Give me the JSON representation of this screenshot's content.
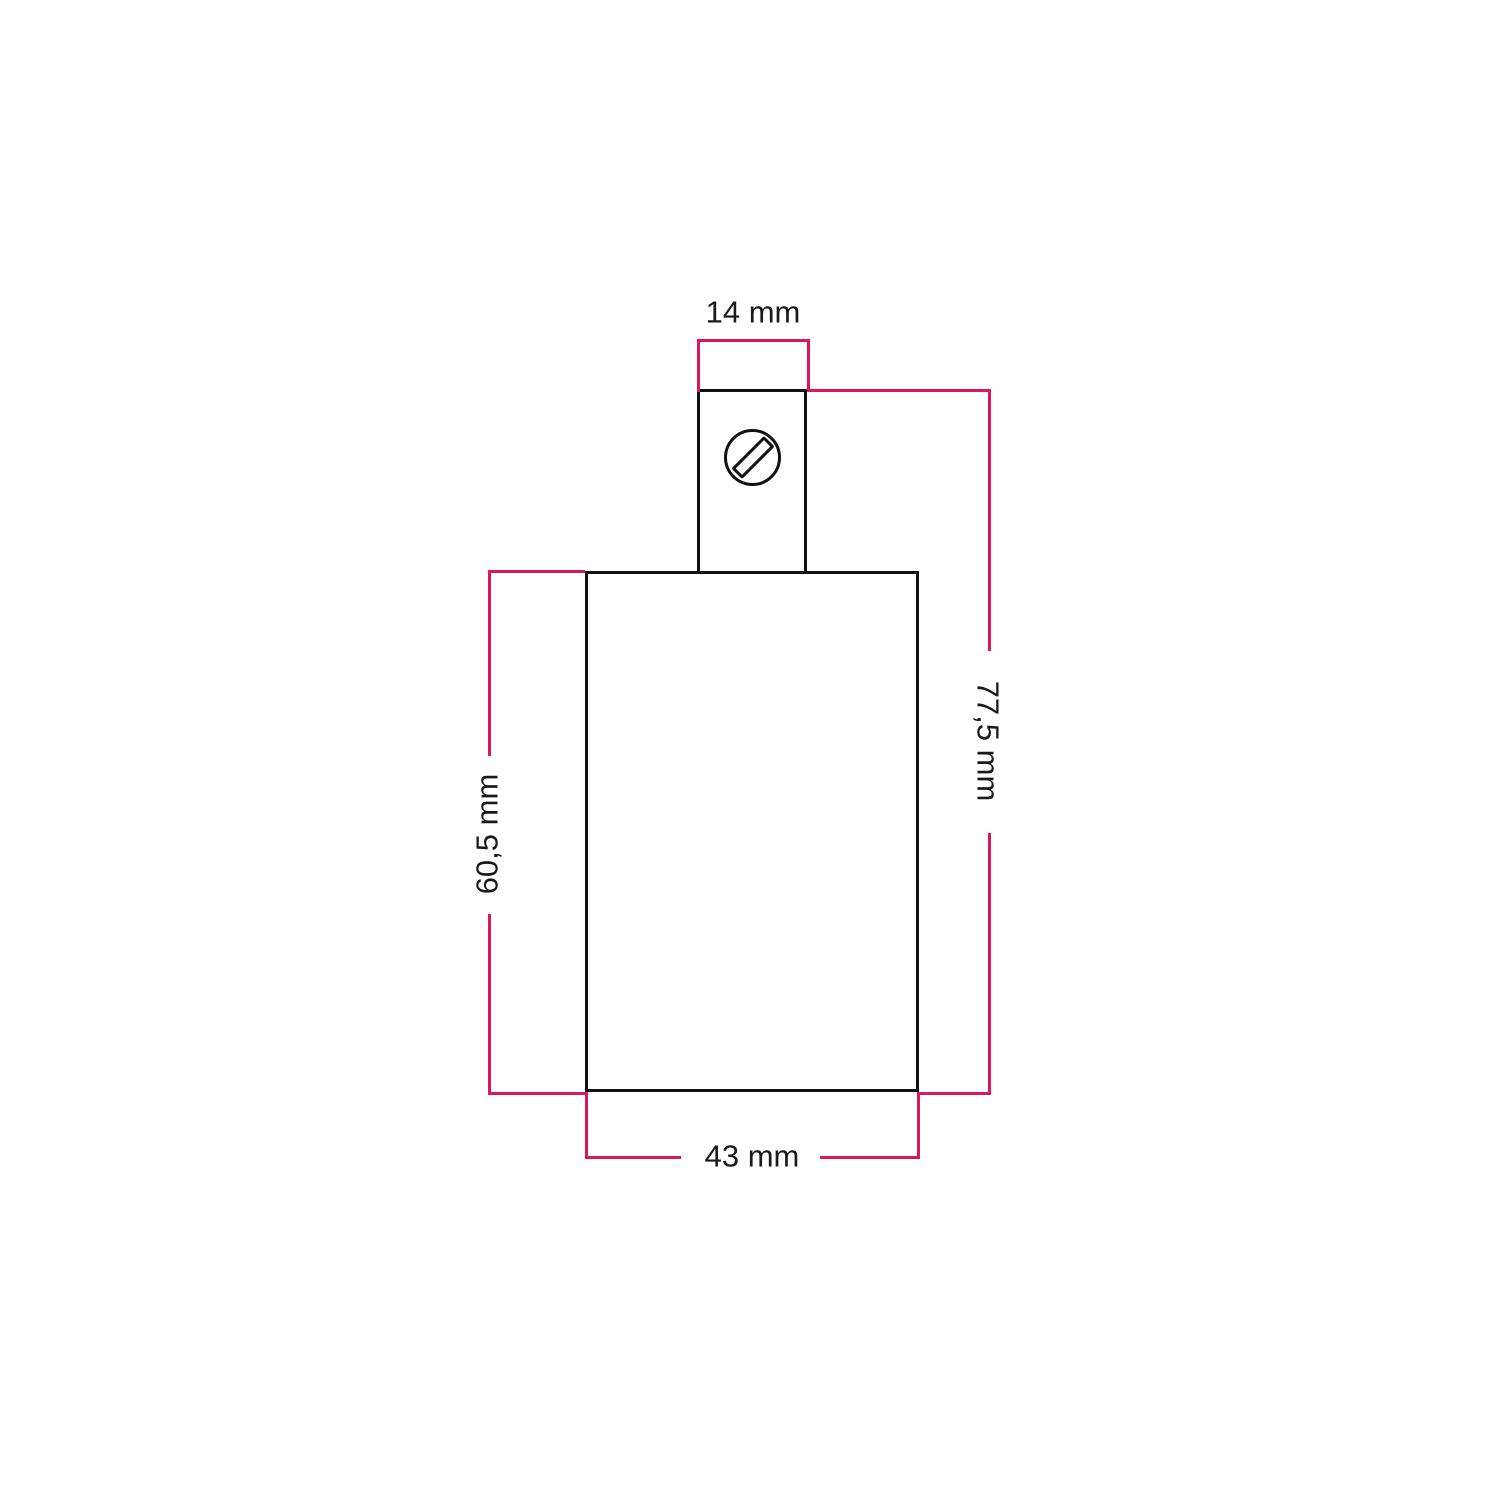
{
  "colors": {
    "dimension": "#e0155f",
    "outline": "#111111",
    "text": "#1a1a1a",
    "background": "#ffffff"
  },
  "icons": {
    "screw": "slotted-screw-icon"
  },
  "dimensions": {
    "neck_width": {
      "label": "14 mm",
      "value": "14",
      "unit": "mm"
    },
    "overall_height": {
      "label": "77,5 mm",
      "value": "77,5",
      "unit": "mm"
    },
    "body_height": {
      "label": "60,5 mm",
      "value": "60,5",
      "unit": "mm"
    },
    "body_width": {
      "label": "43 mm",
      "value": "43",
      "unit": "mm"
    }
  }
}
